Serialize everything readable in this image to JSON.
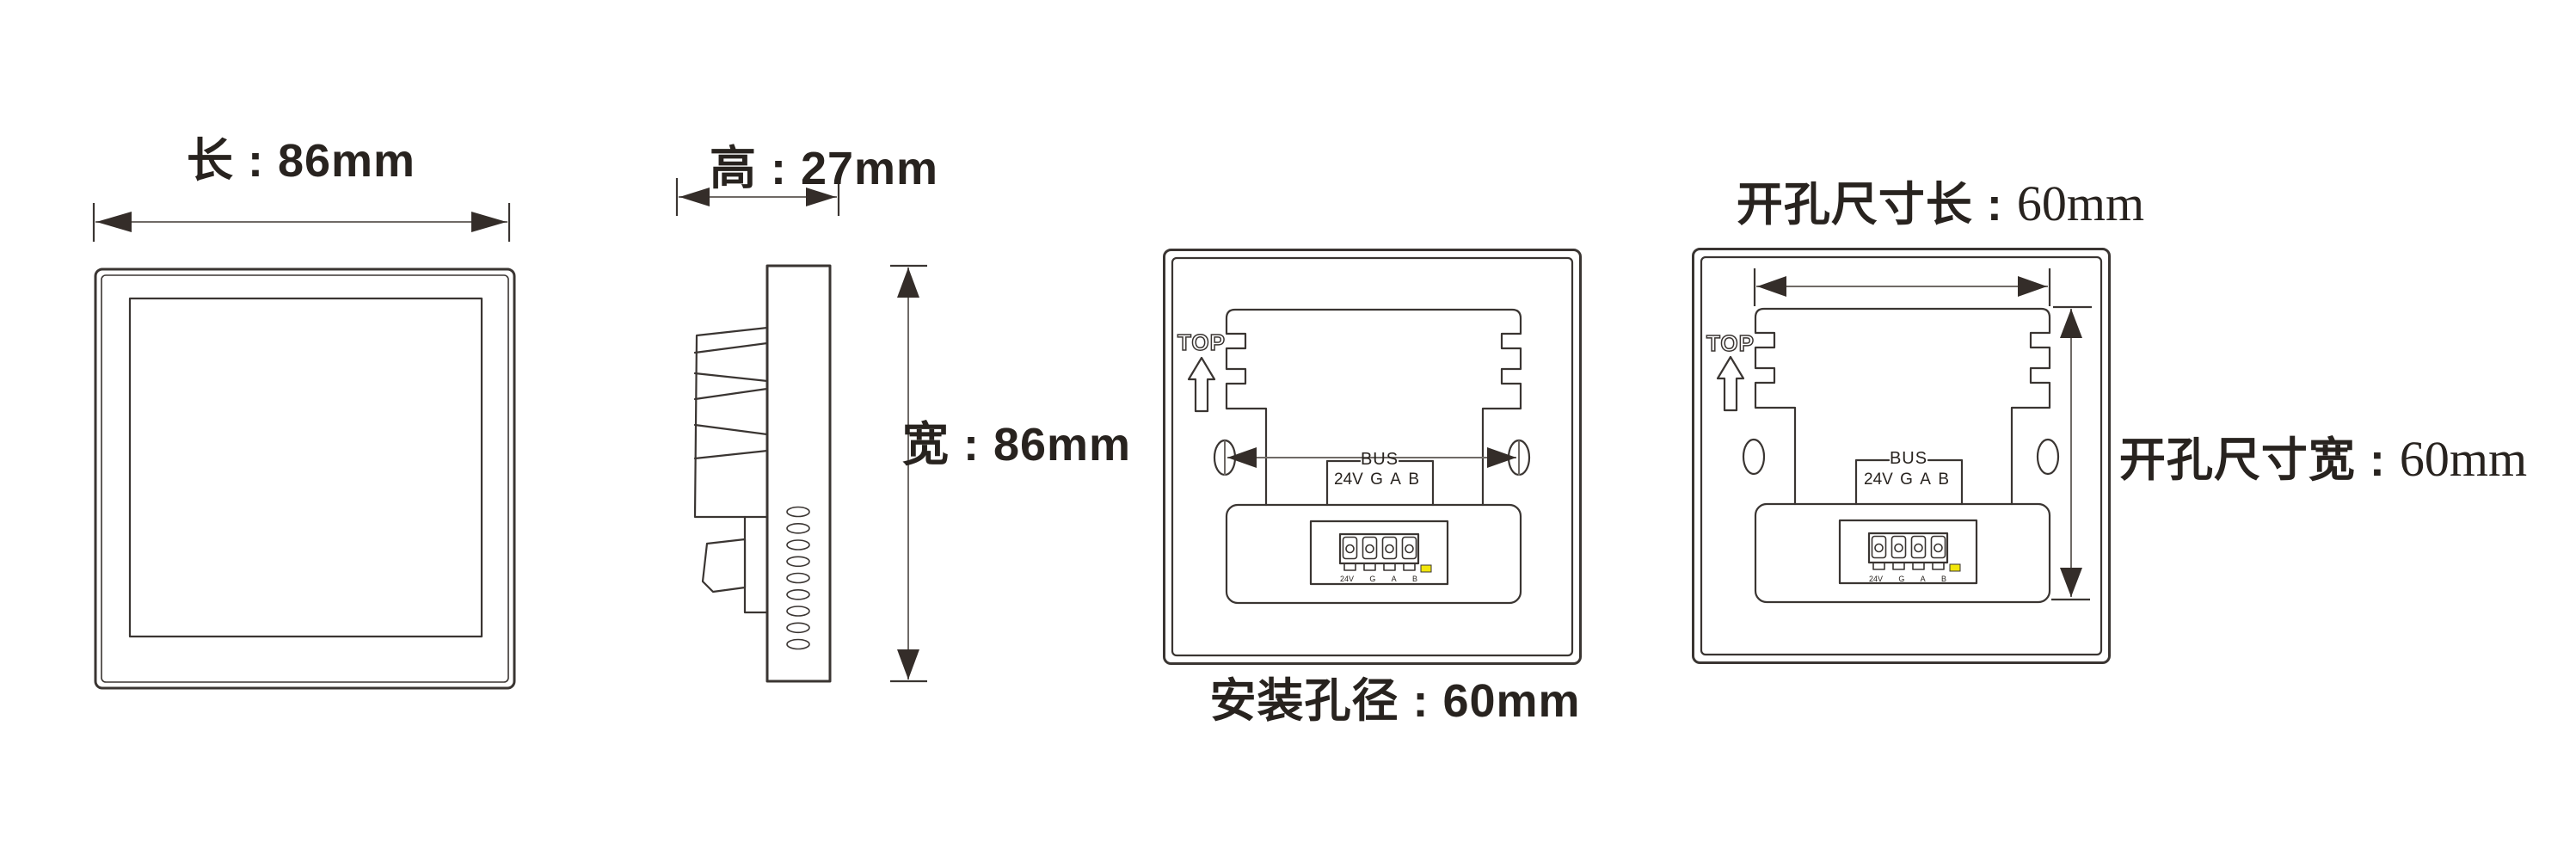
{
  "labels": {
    "front_length": "长 : 86mm",
    "side_height": "高 : 27mm",
    "side_width": "宽 : 86mm",
    "mounting_caption": "安装孔径 : 60mm",
    "cutout_length_prefix": "开孔尺寸长 : ",
    "cutout_length_value": "60mm",
    "cutout_width_prefix": "开孔尺寸宽 : ",
    "cutout_width_value": "60mm",
    "top_marker": "TOP",
    "bus_title": "BUS"
  },
  "bus_pins": [
    "24V",
    "G",
    "A",
    "B"
  ],
  "terminal_pins": [
    "24V",
    "G",
    "A",
    "B"
  ],
  "dimensions": {
    "length_mm": 86,
    "height_mm": 27,
    "width_mm": 86,
    "mounting_hole_spacing_mm": 60,
    "cutout_length_mm": 60,
    "cutout_width_mm": 60
  },
  "colors": {
    "line": "#3a3532",
    "dim": "#6f6a66",
    "arrow": "#342d29",
    "led": "#f2e60a",
    "text": "#28231f",
    "bg": "#ffffff"
  }
}
